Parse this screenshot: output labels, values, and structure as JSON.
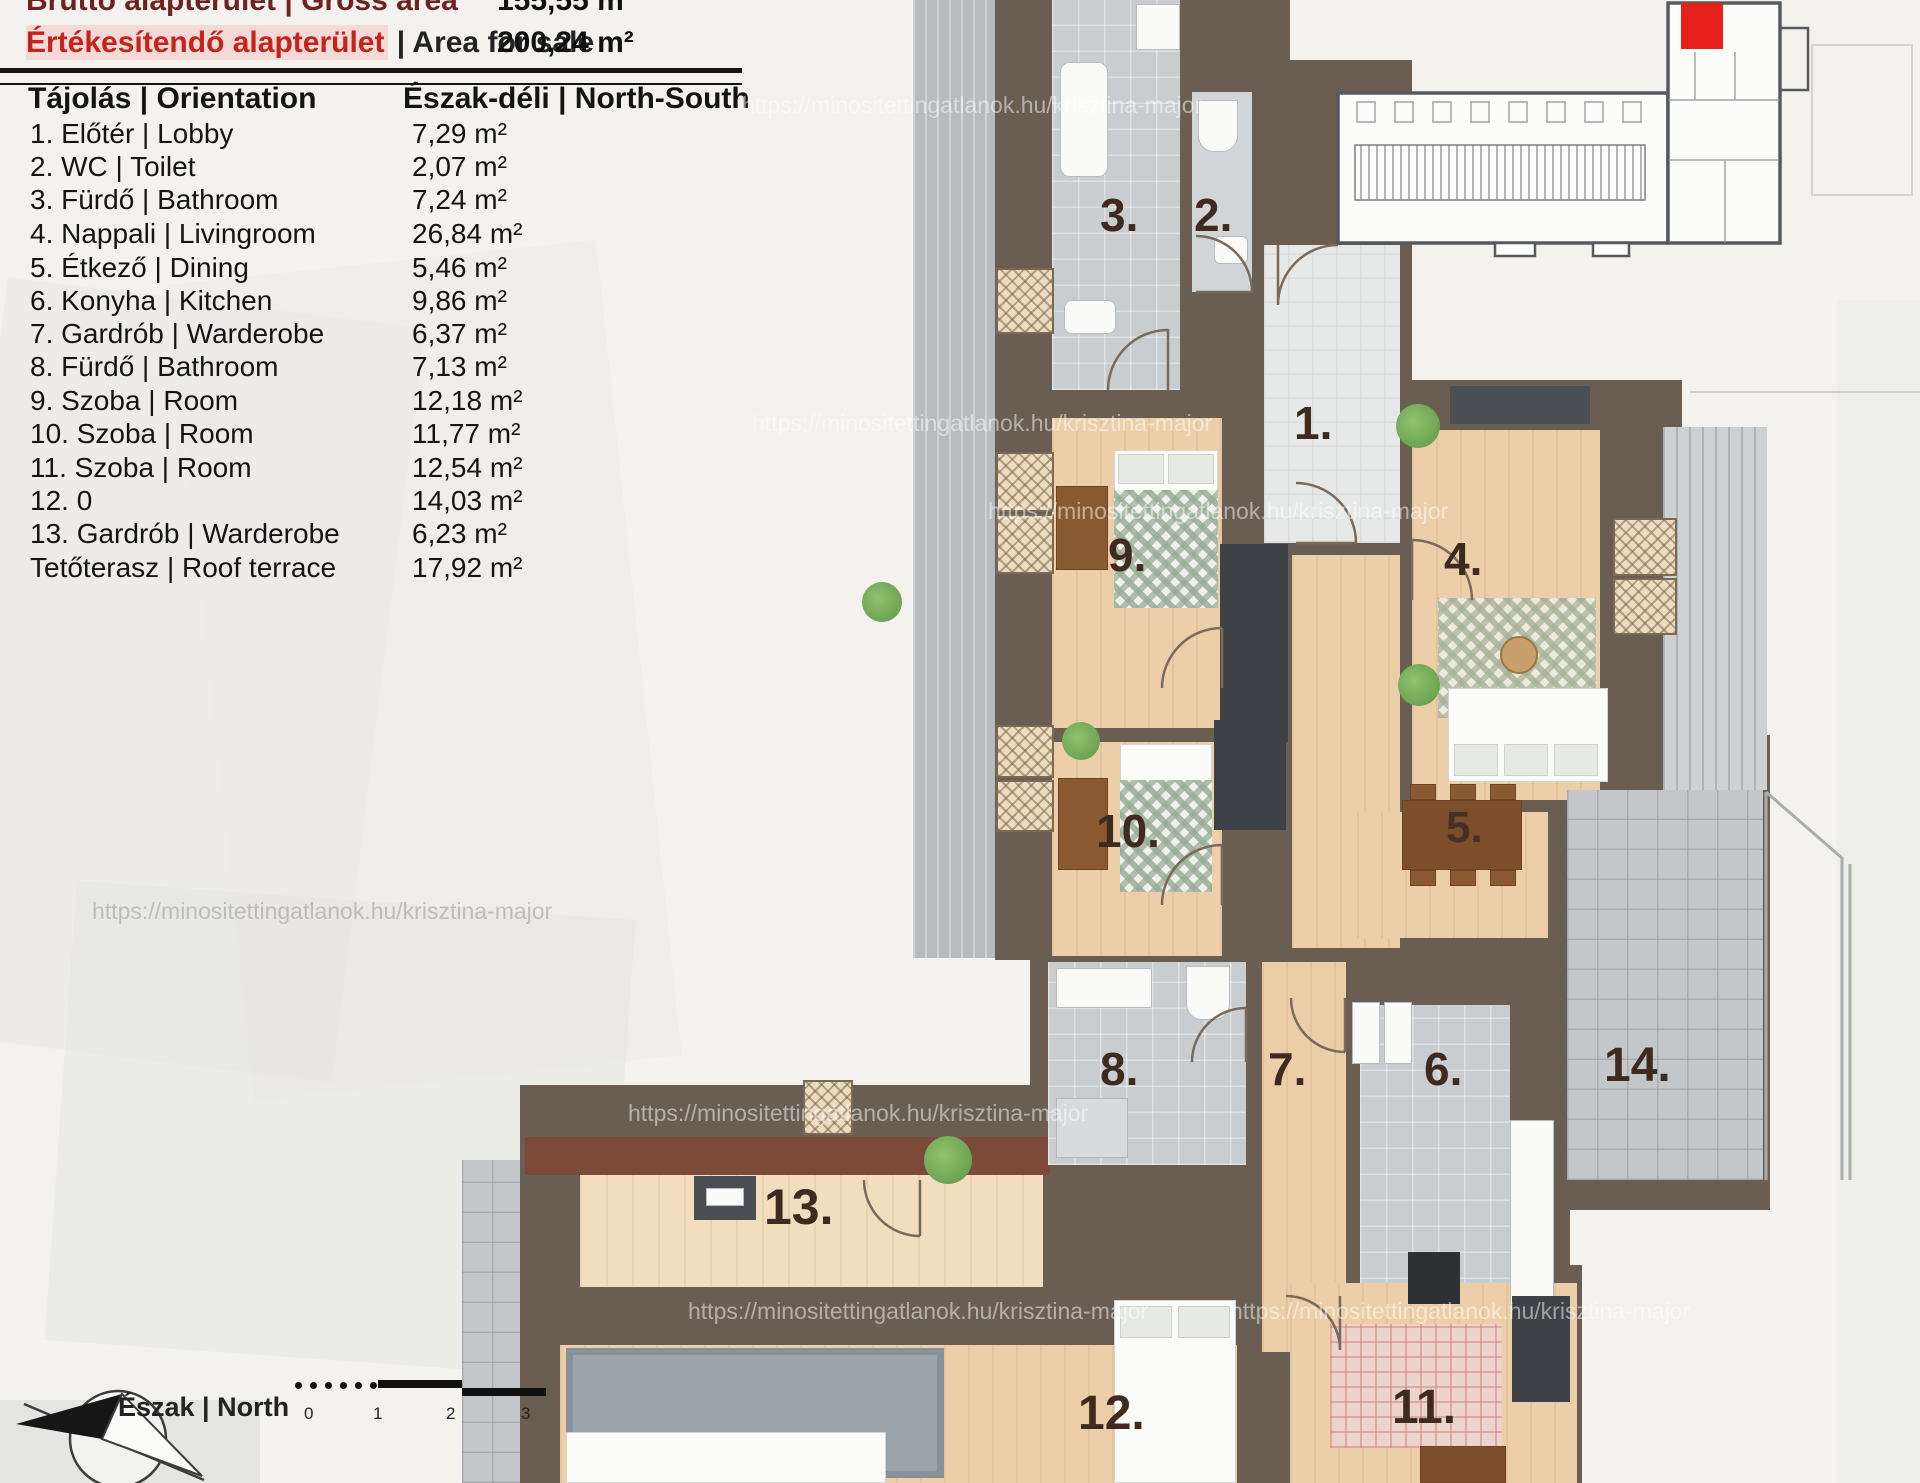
{
  "header": {
    "gross": {
      "label": "Bruttó alapterület | Gross area",
      "value": "155,55 m²"
    },
    "sale": {
      "label_hu": "Értékesítendő alapterület",
      "label_en": "| Area for sale",
      "value": "200,24 m²"
    },
    "orientation": {
      "label": "Tájolás | Orientation",
      "value": "Észak-déli | North-South"
    }
  },
  "rooms": [
    {
      "label": "1. Előtér | Lobby",
      "area": "7,29 m²"
    },
    {
      "label": "2. WC | Toilet",
      "area": "2,07 m²"
    },
    {
      "label": "3. Fürdő | Bathroom",
      "area": "7,24 m²"
    },
    {
      "label": "4. Nappali | Livingroom",
      "area": "26,84 m²"
    },
    {
      "label": "5. Étkező | Dining",
      "area": "5,46 m²"
    },
    {
      "label": "6. Konyha | Kitchen",
      "area": "9,86 m²"
    },
    {
      "label": "7. Gardrób | Warderobe",
      "area": "6,37 m²"
    },
    {
      "label": "8. Fürdő | Bathroom",
      "area": "7,13 m²"
    },
    {
      "label": "9. Szoba | Room",
      "area": "12,18 m²"
    },
    {
      "label": "10. Szoba | Room",
      "area": "11,77 m²"
    },
    {
      "label": "11. Szoba | Room",
      "area": "12,54 m²"
    },
    {
      "label": "12. 0",
      "area": "14,03 m²"
    },
    {
      "label": "13. Gardrób | Warderobe",
      "area": "6,23 m²"
    },
    {
      "label": "Tetőterasz | Roof terrace",
      "area": "17,92 m²"
    }
  ],
  "plan": {
    "room_numbers": [
      "1.",
      "2.",
      "3.",
      "4.",
      "5.",
      "6.",
      "7.",
      "8.",
      "9.",
      "10.",
      "11.",
      "12.",
      "13.",
      "14."
    ],
    "colors": {
      "wall": "#6a5e53",
      "accent_wall": "#7c4a38",
      "unit_marker": "#e6201a"
    }
  },
  "compass": {
    "label": "Észak | North"
  },
  "scale": {
    "ticks": [
      "0",
      "1",
      "2",
      "3"
    ]
  },
  "watermark": {
    "text": "https://minositettingatlanok.hu/krisztina-major"
  }
}
